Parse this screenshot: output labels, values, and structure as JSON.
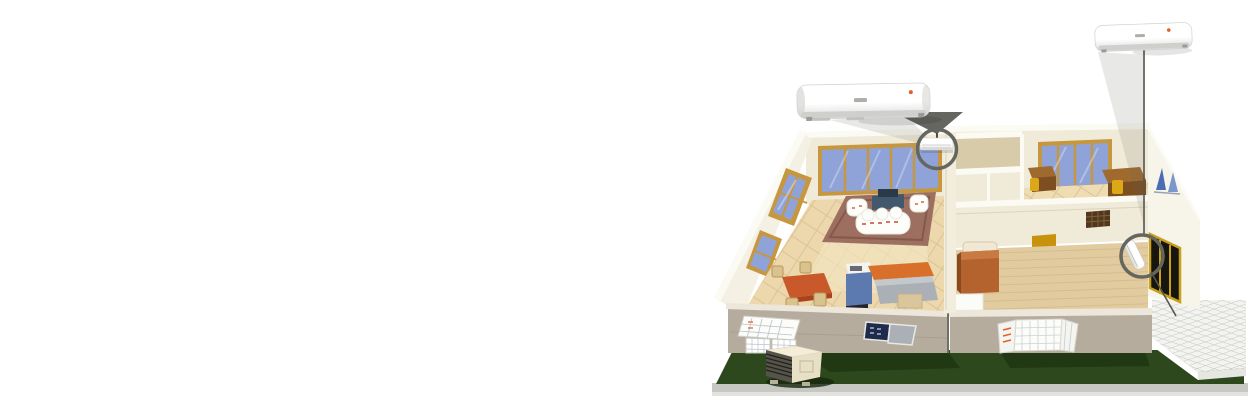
{
  "page": {
    "background": "#ffffff"
  },
  "scene": {
    "type": "product-illustration",
    "subject": "house-cutaway-with-two-split-air-conditioners",
    "indoor_units": [
      {
        "name": "wall-mounted-indoor-unit-living-room",
        "enlarged": true,
        "location": "living-room-partition-wall"
      },
      {
        "name": "wall-mounted-indoor-unit-bedroom",
        "enlarged": true,
        "location": "bedroom-side-wall"
      }
    ],
    "outdoor_unit": {
      "name": "outdoor-condenser-unit",
      "location": "front-lawn"
    },
    "highlights": [
      {
        "name": "magnifier-ring-living-room"
      },
      {
        "name": "magnifier-ring-bedroom"
      }
    ],
    "rooms": [
      "living-room",
      "dining-kitchen",
      "study",
      "bedroom",
      "patio"
    ]
  },
  "colors": {
    "pageBg": "#ffffff",
    "lawn": "#2d481d",
    "lawnShadow": "#1b3211",
    "base": "#c7c7c3",
    "baseLight": "#e2e2de",
    "wall": "#f0ead9",
    "wallTop": "#fbfaf3",
    "tanwall": "#d8cbaa",
    "exwall": "#b6ac9d",
    "exwallTop": "#ece7da",
    "floor": "#ecd8ac",
    "floorLight": "#f5e7c5",
    "floorLine": "#c9a873",
    "floor2": "#e2cb9f",
    "plankLine": "#c4ab80",
    "studyFloor": "#eedcb2",
    "frame": "#c6973f",
    "glass": "#8fa3d8",
    "rug": "#9c6f60",
    "rugBorder": "#7d5446",
    "sofa": "#fdfdfa",
    "sofaRed": "#c44a38",
    "tvTable": "#41586d",
    "dining": "#c9582b",
    "chair": "#d9c28d",
    "counter": "#d8702c",
    "island": "#aab0b6",
    "islandTop": "#c2c8cc",
    "cabinet": "#5d7ab0",
    "bed": "#b4632e",
    "bedHead": "#f0e7d4",
    "door": "#c7920e",
    "vent": "#53371d",
    "doorway": "#16160f",
    "doorframe": "#c9a01c",
    "patio": "#f3f3ef",
    "patioLine": "#c6cac7",
    "callout": "#64665f",
    "lineColor": "#55574f",
    "acBody": "#ffffff",
    "acBody2": "#dadad8",
    "acBottom": "#cfcfcd",
    "logoGray": "#9a9a98",
    "dotOrange": "#e0622e",
    "desk": "#7d4e20",
    "deskTop": "#a06a2e",
    "chairYellow": "#dca818",
    "sail": "#4a6cb4",
    "sail2": "#7a96cc",
    "grille": "#55534a",
    "grilleLine": "#23231e",
    "condenser": "#e8e0c6"
  }
}
